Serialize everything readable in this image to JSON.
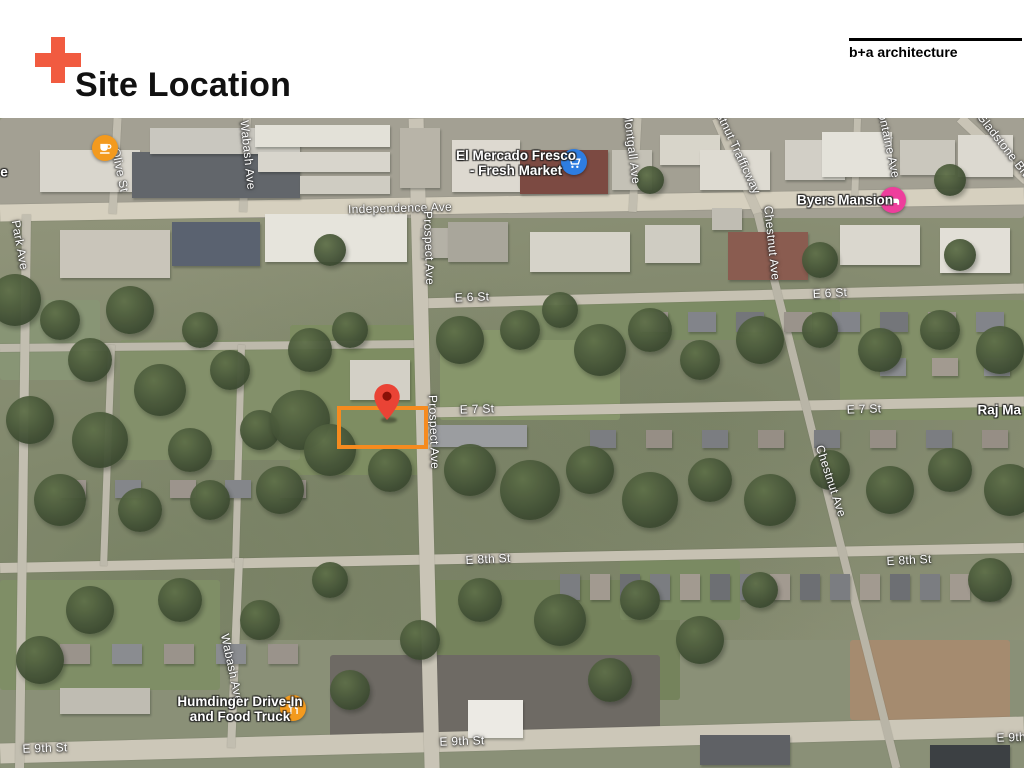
{
  "slide": {
    "title": "Site Location",
    "accent_color": "#F15B40",
    "brand": "b+a architecture"
  },
  "map": {
    "description": "aerial satellite map of site vicinity",
    "street_labels": [
      {
        "text": "Independence Ave",
        "x": 400,
        "y": 208,
        "rot": -1.5
      },
      {
        "text": "E 6 St",
        "x": 472,
        "y": 297,
        "rot": -2
      },
      {
        "text": "E 6 St",
        "x": 830,
        "y": 293,
        "rot": -3
      },
      {
        "text": "E 7 St",
        "x": 477,
        "y": 409,
        "rot": -2
      },
      {
        "text": "E 7 St",
        "x": 864,
        "y": 409,
        "rot": -2
      },
      {
        "text": "E 8th St",
        "x": 488,
        "y": 559,
        "rot": -3
      },
      {
        "text": "E 8th St",
        "x": 909,
        "y": 560,
        "rot": -3
      },
      {
        "text": "E 9th St",
        "x": 45,
        "y": 748,
        "rot": -2
      },
      {
        "text": "E 9th St",
        "x": 462,
        "y": 741,
        "rot": -2
      },
      {
        "text": "E 9th St",
        "x": 1019,
        "y": 737,
        "rot": -2
      },
      {
        "text": "Prospect Ave",
        "x": 429,
        "y": 248,
        "rot": 88
      },
      {
        "text": "Prospect Ave",
        "x": 434,
        "y": 432,
        "rot": 88
      },
      {
        "text": "Olive St",
        "x": 120,
        "y": 170,
        "rot": 78
      },
      {
        "text": "Wabash Ave",
        "x": 248,
        "y": 155,
        "rot": 84
      },
      {
        "text": "Wabash Ave",
        "x": 232,
        "y": 668,
        "rot": 78
      },
      {
        "text": "Park Ave",
        "x": 20,
        "y": 245,
        "rot": 80
      },
      {
        "text": "Montgall Ave",
        "x": 632,
        "y": 148,
        "rot": 83
      },
      {
        "text": "Chestnut Trafficway",
        "x": 734,
        "y": 143,
        "rot": 65
      },
      {
        "text": "Chestnut Ave",
        "x": 772,
        "y": 243,
        "rot": 84
      },
      {
        "text": "Chestnut Ave",
        "x": 831,
        "y": 481,
        "rot": 72
      },
      {
        "text": "Bellefontaine Ave",
        "x": 886,
        "y": 130,
        "rot": 78
      },
      {
        "text": "Gladstone Blvd",
        "x": 1006,
        "y": 148,
        "rot": 52
      }
    ],
    "poi_labels": [
      {
        "lines": [
          "El Mercado Fresco",
          "- Fresh Market"
        ],
        "x": 516,
        "y": 164,
        "name": "el-mercado-fresco-label"
      },
      {
        "lines": [
          "Byers Mansion"
        ],
        "x": 845,
        "y": 201,
        "name": "byers-mansion-label"
      },
      {
        "lines": [
          "Humdinger Drive-In",
          "and Food Truck"
        ],
        "x": 240,
        "y": 710,
        "name": "humdinger-drive-in-label"
      },
      {
        "lines": [
          "Raj Ma H"
        ],
        "x": 1006,
        "y": 411,
        "name": "raj-ma-label"
      },
      {
        "lines": [
          "e"
        ],
        "x": 4,
        "y": 173,
        "name": "clipped-place-label"
      }
    ],
    "markers": [
      {
        "icon": "cafe",
        "color": "#F39A1E",
        "x": 105,
        "y": 148,
        "name": "cafe-marker"
      },
      {
        "icon": "grocery",
        "color": "#2E7DE1",
        "x": 574,
        "y": 162,
        "name": "grocery-store-marker"
      },
      {
        "icon": "lodging",
        "color": "#EE3E9C",
        "x": 893,
        "y": 200,
        "name": "lodging-marker"
      },
      {
        "icon": "restaurant",
        "color": "#F39A1E",
        "x": 293,
        "y": 708,
        "name": "restaurant-marker"
      }
    ],
    "site": {
      "pin_color": "#EA4335",
      "pin_x": 387,
      "pin_y": 420,
      "rect": {
        "x": 337,
        "y": 406,
        "w": 91,
        "h": 43
      },
      "outline_color": "#F68B1F"
    }
  }
}
